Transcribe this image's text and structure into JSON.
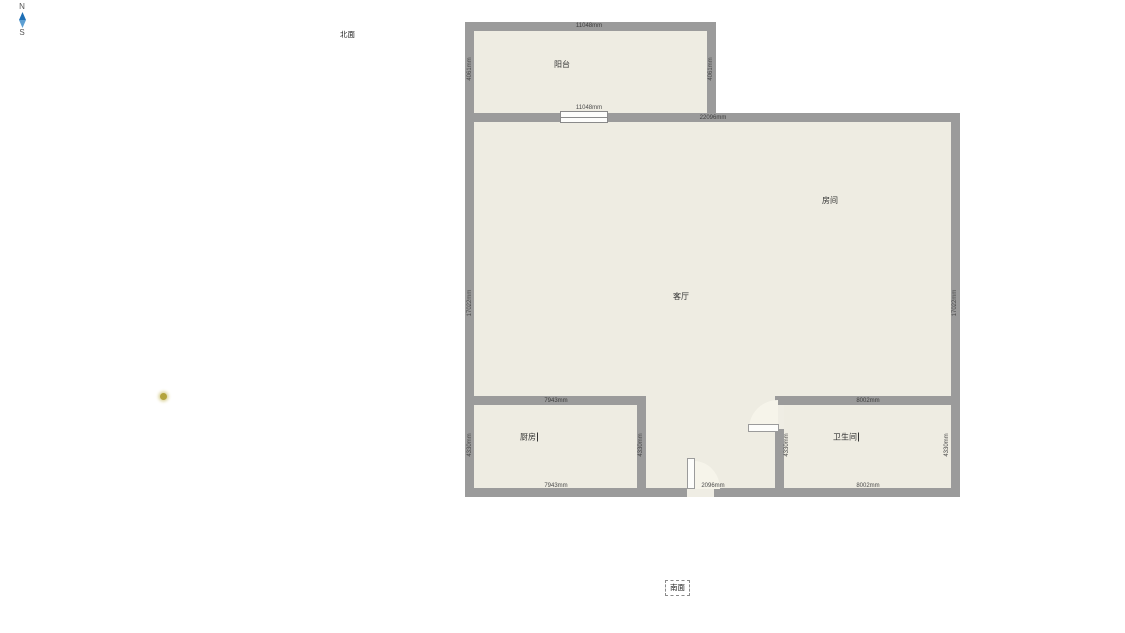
{
  "compass": {
    "north": "N",
    "south": "S",
    "arrow_top_color": "#1e6fb5",
    "arrow_bottom_color": "#5d9fd3"
  },
  "orientation": {
    "north_side": "北面",
    "south_side": "南面"
  },
  "rooms": {
    "balcony": {
      "label": "阳台"
    },
    "bedroom": {
      "label": "房间"
    },
    "living": {
      "label": "客厅"
    },
    "kitchen": {
      "label": "厨房"
    },
    "bathroom": {
      "label": "卫生间"
    }
  },
  "dims": {
    "balcony_top": "11048mm",
    "balcony_bottom": "11048mm",
    "balcony_left": "4061mm",
    "balcony_right": "4061mm",
    "main_top": "22096mm",
    "main_left": "17022mm",
    "main_right": "17022mm",
    "kitchen_top": "7943mm",
    "kitchen_bottom": "7943mm",
    "kitchen_left": "4330mm",
    "kitchen_right": "4330mm",
    "bath_top": "8002mm",
    "bath_bottom": "8002mm",
    "bath_left": "4330mm",
    "bath_right": "4330mm",
    "entry_door": "2096mm"
  },
  "colors": {
    "wall": "#9b9b9b",
    "floor": "#eeece2",
    "marker_dot": "#b3a43e"
  }
}
